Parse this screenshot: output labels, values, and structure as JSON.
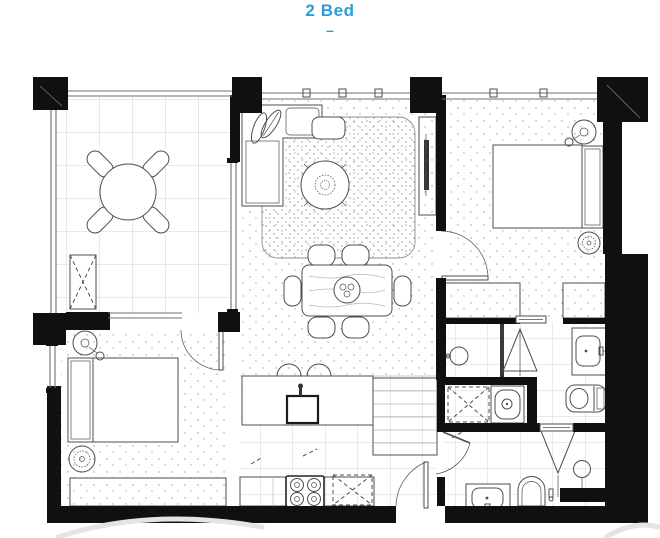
{
  "header": {
    "title": "2 Bed",
    "divider": "–"
  },
  "colors": {
    "accent": "#2B9CD9",
    "wall": "#101010",
    "line": "#4d4d4d",
    "tile": "#c6c6c6",
    "stipple": "#9a9a9a",
    "watermark": "#e4e4e4"
  },
  "plan": {
    "type": "apartment-floor-plan",
    "rooms": [
      {
        "name": "balcony",
        "fixtures": [
          "outdoor-dining-table",
          "outdoor-chairs",
          "planter-bench",
          "balustrade"
        ]
      },
      {
        "name": "living-room",
        "fixtures": [
          "l-shaped-sofa",
          "rug",
          "coffee-table",
          "ottoman",
          "tv-unit"
        ]
      },
      {
        "name": "dining-area",
        "fixtures": [
          "dining-table",
          "dining-chairs"
        ]
      },
      {
        "name": "kitchen",
        "fixtures": [
          "island-bench",
          "sink",
          "bar-stools",
          "pantry",
          "cooktop",
          "appliance-space",
          "entry-door"
        ]
      },
      {
        "name": "bedroom-1",
        "fixtures": [
          "double-bed",
          "bedside-lamp",
          "plant",
          "wardrobe",
          "door"
        ]
      },
      {
        "name": "bedroom-2",
        "fixtures": [
          "double-bed",
          "bedside-lamp",
          "plant",
          "wardrobe",
          "window",
          "door"
        ]
      },
      {
        "name": "ensuite",
        "fixtures": [
          "shower",
          "shower-screen",
          "vanity-basin",
          "toilet"
        ]
      },
      {
        "name": "laundry",
        "fixtures": [
          "washing-machine-space",
          "laundry-tub"
        ]
      },
      {
        "name": "bathroom",
        "fixtures": [
          "shower",
          "vanity-basin",
          "toilet",
          "door"
        ]
      }
    ]
  }
}
